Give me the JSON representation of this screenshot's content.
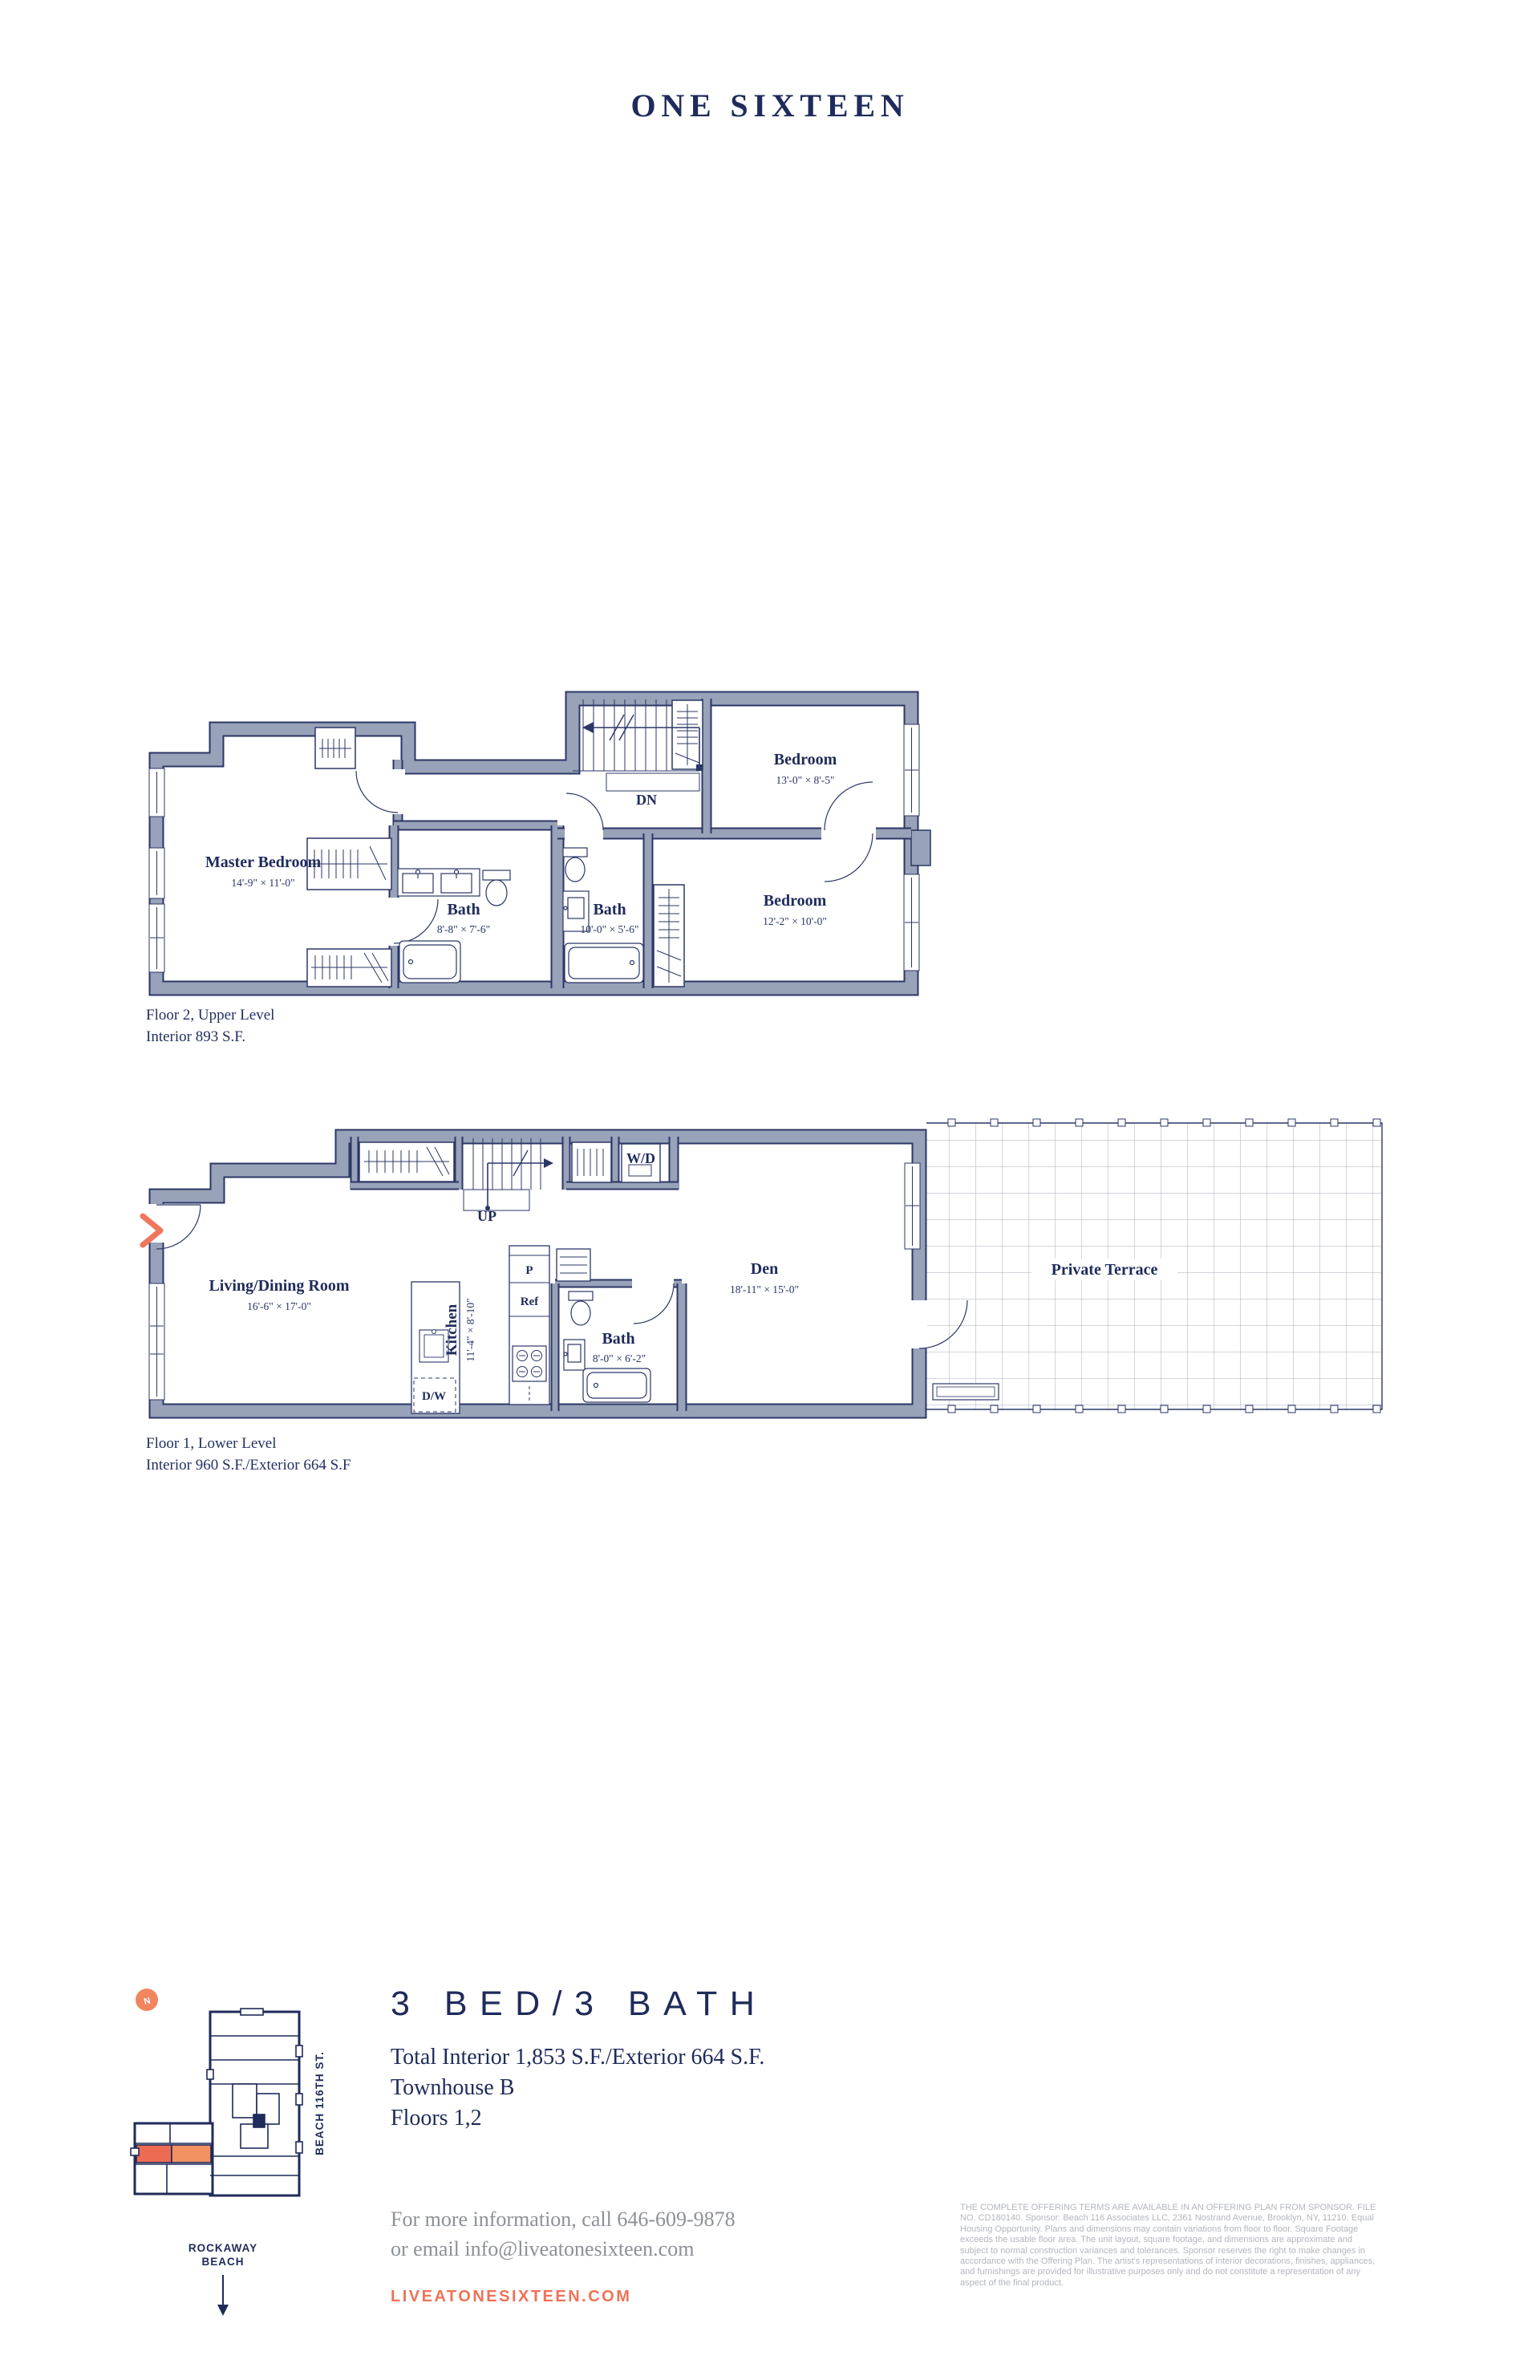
{
  "page": {
    "title": "ONE SIXTEEN"
  },
  "colors": {
    "navy": "#1f2b5a",
    "plan_line": "#2b3766",
    "wall_gray": "#98a2b8",
    "coral": "#ee7257",
    "coral_chevron": "#f0765c",
    "coral_badge": "#f0855e",
    "unit_highlight_dark": "#ed6b52",
    "unit_highlight_light": "#f29263",
    "contact_gray": "#8c9197",
    "legal_gray": "#b2b6bd"
  },
  "floor2": {
    "caption_line1": "Floor 2, Upper Level",
    "caption_line2": "Interior 893 S.F.",
    "rooms": {
      "master": {
        "name": "Master Bedroom",
        "dims": "14'-9\" × 11'-0\""
      },
      "bath1": {
        "name": "Bath",
        "dims": "8'-8\" × 7'-6\""
      },
      "bath2": {
        "name": "Bath",
        "dims": "10'-0\" × 5'-6\""
      },
      "bedroom1": {
        "name": "Bedroom",
        "dims": "13'-0\" × 8'-5\""
      },
      "bedroom2": {
        "name": "Bedroom",
        "dims": "12'-2\" × 10'-0\""
      }
    },
    "labels": {
      "down": "DN"
    }
  },
  "floor1": {
    "caption_line1": "Floor 1, Lower Level",
    "caption_line2": "Interior 960 S.F./Exterior 664 S.F",
    "rooms": {
      "living": {
        "name": "Living/Dining Room",
        "dims": "16'-6\" × 17'-0\""
      },
      "kitchen": {
        "name": "Kitchen",
        "dims": "11'-4\" × 8'-10\""
      },
      "bath": {
        "name": "Bath",
        "dims": "8'-0\" × 6'-2\""
      },
      "den": {
        "name": "Den",
        "dims": "18'-11\" × 15'-0\""
      },
      "terrace": {
        "name": "Private Terrace"
      }
    },
    "labels": {
      "up": "UP",
      "washer_dryer": "W/D",
      "pantry": "P",
      "fridge": "Ref",
      "dishwasher": "D/W"
    }
  },
  "keymap": {
    "north": "N",
    "street": "BEACH 116TH ST.",
    "beach_line1": "ROCKAWAY",
    "beach_line2": "BEACH"
  },
  "summary": {
    "headline": "3 BED/3 BATH",
    "line1": "Total Interior 1,853 S.F./Exterior 664 S.F.",
    "line2": "Townhouse B",
    "line3": "Floors 1,2",
    "contact_line1": "For more information, call 646-609-9878",
    "contact_line2": "or email info@liveatonesixteen.com",
    "website": "LIVEATONESIXTEEN.COM"
  },
  "legal": "THE COMPLETE OFFERING TERMS ARE AVAILABLE IN AN OFFERING PLAN FROM SPONSOR. FILE NO. CD180140. Sponsor: Beach 116 Associates LLC, 2361 Nostrand Avenue, Brooklyn, NY, 11210. Equal Housing Opportunity. Plans and dimensions may contain variations from floor to floor. Square Footage exceeds the usable floor area. The unit layout, square footage, and dimensions are approximate and subject to normal construction variances and tolerances. Sponsor reserves the right to make changes in accordance with the Offering Plan. The artist's representations of interior decorations, finishes, appliances, and furnishings are provided for illustrative purposes only and do not constitute a representation of any aspect of the final product."
}
